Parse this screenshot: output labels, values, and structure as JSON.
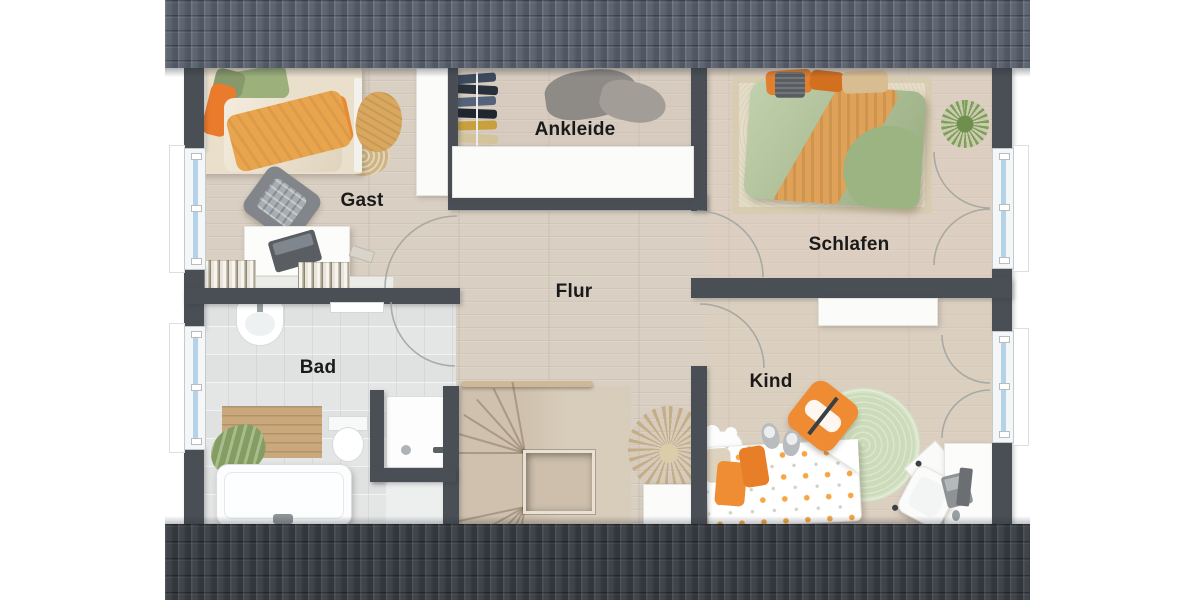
{
  "rooms": [
    {
      "id": "gast",
      "label": "Gast"
    },
    {
      "id": "ankleide",
      "label": "Ankleide"
    },
    {
      "id": "schlafen",
      "label": "Schlafen"
    },
    {
      "id": "flur",
      "label": "Flur"
    },
    {
      "id": "bad",
      "label": "Bad"
    },
    {
      "id": "kind",
      "label": "Kind"
    }
  ],
  "colors": {
    "background": "#ffffff",
    "roof_top": "#59616d",
    "roof_bottom": "#3c4147",
    "wall": "#4a4f55",
    "wood_floor": "#d9cfc2",
    "tile_floor": "#e4e6e6",
    "window_glass": "#b5d3e8",
    "label_text": "#1a1a1a",
    "accent_orange": "#e8953d",
    "accent_green": "#a9bf8e",
    "rug_green": "#ccdcba",
    "stairs_wood": "#d3c5b2"
  },
  "furniture": {
    "gast": [
      "single-bed",
      "throw-blanket",
      "jute-rug",
      "armchair",
      "desk",
      "laptop",
      "books"
    ],
    "ankleide": [
      "clothes-rail",
      "hanging-clothes",
      "clothes-pile",
      "wardrobe"
    ],
    "schlafen": [
      "double-bed",
      "rug",
      "pillows",
      "storage-basket",
      "plant"
    ],
    "flur": [
      "staircase",
      "handrail",
      "dried-flowers",
      "planter"
    ],
    "bad": [
      "washbasin",
      "toilet",
      "bathtub",
      "shower",
      "bath-mat",
      "towel"
    ],
    "kind": [
      "bed",
      "round-rug",
      "fox-cushion",
      "slippers",
      "desk",
      "desk-chair",
      "monitor",
      "cloud-shelf",
      "floor-cushions"
    ]
  }
}
